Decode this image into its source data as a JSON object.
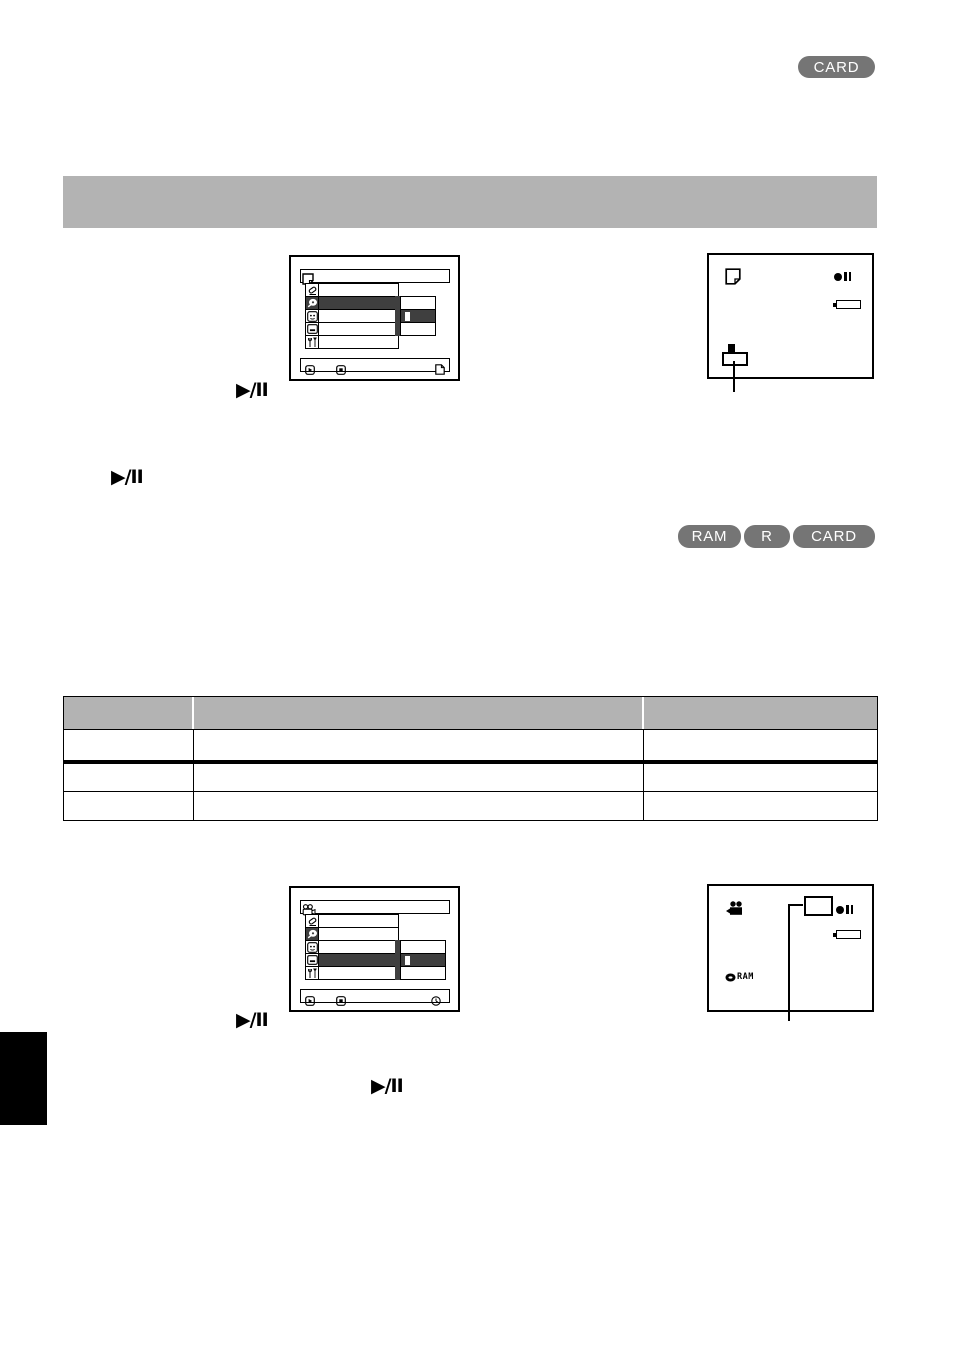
{
  "page": {
    "width": 954,
    "height": 1352,
    "background": "#ffffff"
  },
  "colors": {
    "badge_gray": "#757575",
    "section_bar_gray": "#b3b3b3",
    "table_header_gray": "#b3b3b3",
    "menu_selected_dark": "#3f3f3f",
    "ink": "#000000"
  },
  "top_right_badge": {
    "label": "CARD"
  },
  "controls": {
    "play_pause_label": "▶/II"
  },
  "media_badges": [
    {
      "label": "RAM"
    },
    {
      "label": "R"
    },
    {
      "label": "CARD"
    }
  ],
  "menu_screen_1": {
    "title_icon": "card-page-icon",
    "row_icons": [
      "wipe-fade-icon",
      "disc-record-icon",
      "date-setup-icon",
      "display-setup-icon",
      "initial-setup-icon"
    ],
    "selected_row_index": 1,
    "footer_icons": [
      "play-button-icon",
      "stop-button-icon",
      "page-quit-icon"
    ]
  },
  "status_screen_1": {
    "indicator_icons": [
      "card-page-icon",
      "record-pause-icon",
      "battery-icon"
    ],
    "callout": "highlighted-selection-box-with-leader-line"
  },
  "table": {
    "headers": [
      "",
      "",
      ""
    ],
    "rows": [
      [
        "",
        "",
        ""
      ],
      [
        "",
        "",
        ""
      ],
      [
        "",
        "",
        ""
      ]
    ]
  },
  "menu_screen_2": {
    "title_icon": "movie-camera-icon",
    "row_icons": [
      "wipe-fade-icon",
      "disc-record-icon",
      "date-setup-icon",
      "display-setup-icon",
      "initial-setup-icon"
    ],
    "selected_row_index": 3,
    "footer_icons": [
      "play-button-icon",
      "stop-button-icon",
      "clock-icon"
    ]
  },
  "status_screen_2": {
    "indicator_icons": [
      "movie-camera-icon",
      "record-pause-icon",
      "battery-icon",
      "disc-ram-icon"
    ],
    "ram_label": "RAM",
    "callout": "highlighted-selection-box-with-leader-line"
  }
}
